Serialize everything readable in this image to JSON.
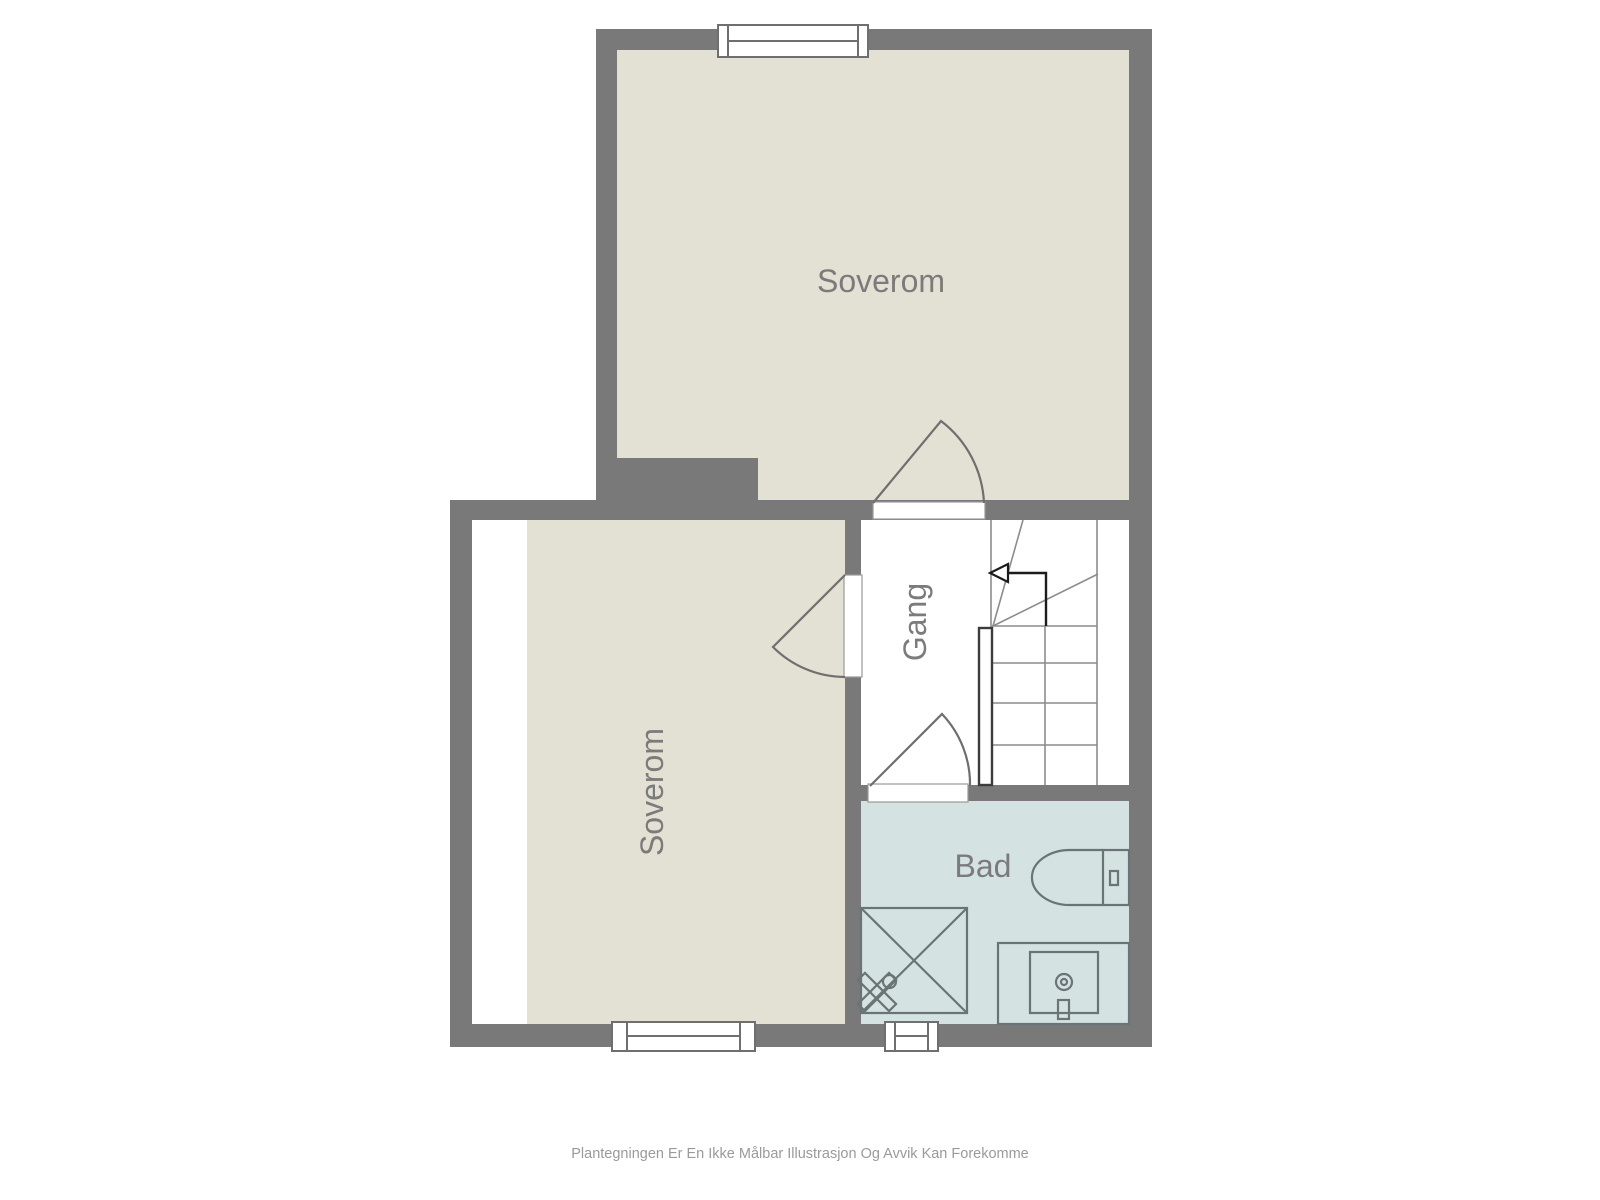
{
  "rooms": {
    "bedroom_top": {
      "label": "Soverom"
    },
    "bedroom_lower": {
      "label": "Soverom"
    },
    "hallway": {
      "label": "Gang"
    },
    "bathroom": {
      "label": "Bad"
    }
  },
  "fixtures": {
    "toilet": "toilet",
    "shower": "shower-with-valve",
    "sink": "sink-vanity",
    "stairs": "staircase-up-arrow"
  },
  "palette": {
    "wall": "#797979",
    "floor_beige": "#e3e0d4",
    "floor_bath": "#d5e2e2",
    "floor_white": "#ffffff",
    "label_text": "#7b7b7b",
    "fixture_outline": "#6a7375",
    "stair_line": "#8c8c8c",
    "door_line": "#6f6f6f",
    "arrow": "#1c1c1c",
    "footer_text": "#9a9a9a",
    "page_bg": "#ffffff"
  },
  "footer": {
    "disclaimer": "Plantegningen Er En Ikke Målbar Illustrasjon Og Avvik Kan Forekomme"
  }
}
